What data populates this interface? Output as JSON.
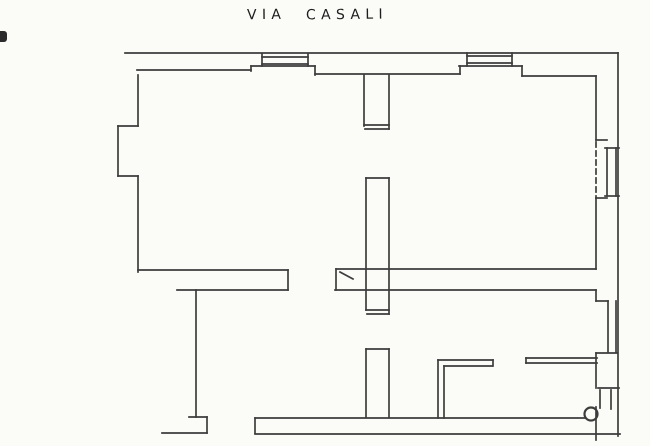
{
  "page": {
    "background_color": "#fbfbf8",
    "ink_color": "#3d3d3d",
    "title": {
      "street_word_1": "VIA",
      "street_word_2": "CASALI"
    }
  },
  "plan": {
    "canvas": {
      "width": 650,
      "height": 446
    },
    "stroke_color": "#3d3d3d",
    "stroke_width": 1.7,
    "wall_groups": [
      {
        "name": "outer-walls",
        "segments": [
          [
            125,
            53,
            618,
            53
          ],
          [
            618,
            53,
            618,
            436
          ],
          [
            255,
            434,
            620,
            434
          ],
          [
            162,
            433,
            207,
            433
          ]
        ]
      },
      {
        "name": "left-wall-with-bay",
        "segments": [
          [
            138,
            75,
            138,
            126
          ],
          [
            138,
            126,
            118,
            126
          ],
          [
            118,
            126,
            118,
            176
          ],
          [
            118,
            176,
            138,
            176
          ],
          [
            138,
            176,
            138,
            272
          ]
        ]
      },
      {
        "name": "top-wall-inner-face",
        "segments": [
          [
            137,
            70,
            251,
            70
          ],
          [
            251,
            66,
            251,
            71
          ],
          [
            251,
            66,
            315,
            66
          ],
          [
            315,
            66,
            315,
            75
          ],
          [
            315,
            74,
            460,
            74
          ],
          [
            460,
            66,
            460,
            74
          ],
          [
            459,
            66,
            522,
            66
          ],
          [
            522,
            66,
            522,
            76
          ],
          [
            522,
            76,
            596,
            76
          ]
        ]
      },
      {
        "name": "top-window-left",
        "segments": [
          [
            262,
            57,
            308,
            57
          ],
          [
            262,
            64,
            308,
            64
          ],
          [
            262,
            54,
            262,
            66
          ],
          [
            308,
            54,
            308,
            66
          ]
        ]
      },
      {
        "name": "top-window-right",
        "segments": [
          [
            467,
            56,
            512,
            56
          ],
          [
            467,
            63,
            512,
            63
          ],
          [
            467,
            53,
            467,
            66
          ],
          [
            512,
            53,
            512,
            66
          ]
        ]
      },
      {
        "name": "partition-upper",
        "segments": [
          [
            364,
            75,
            364,
            126
          ],
          [
            389,
            75,
            389,
            129
          ],
          [
            364,
            125,
            389,
            125
          ],
          [
            365,
            129,
            389,
            129
          ]
        ]
      },
      {
        "name": "partition-middle",
        "segments": [
          [
            366,
            178,
            366,
            310
          ],
          [
            389,
            178,
            389,
            314
          ],
          [
            366,
            178,
            389,
            178
          ],
          [
            366,
            310,
            389,
            310
          ],
          [
            367,
            314,
            389,
            314
          ]
        ]
      },
      {
        "name": "partition-lower",
        "segments": [
          [
            366,
            349,
            366,
            417
          ],
          [
            389,
            349,
            389,
            417
          ],
          [
            366,
            349,
            389,
            349
          ]
        ]
      },
      {
        "name": "cross-wall-left",
        "segments": [
          [
            138,
            270,
            288,
            270
          ],
          [
            177,
            290,
            288,
            290
          ],
          [
            288,
            270,
            288,
            290
          ]
        ]
      },
      {
        "name": "cross-wall-right",
        "segments": [
          [
            336,
            269,
            596,
            269
          ],
          [
            335,
            290,
            596,
            290
          ],
          [
            336,
            269,
            336,
            290
          ]
        ]
      },
      {
        "name": "lower-left-boundary",
        "segments": [
          [
            196,
            290,
            196,
            417
          ],
          [
            189,
            417,
            207,
            417
          ],
          [
            207,
            417,
            207,
            433
          ]
        ]
      },
      {
        "name": "l-shaped-wall",
        "segments": [
          [
            438,
            360,
            493,
            360
          ],
          [
            444,
            366,
            492,
            366
          ],
          [
            493,
            360,
            493,
            366
          ],
          [
            438,
            360,
            438,
            418
          ],
          [
            444,
            366,
            444,
            418
          ]
        ]
      },
      {
        "name": "lower-right-wall",
        "segments": [
          [
            526,
            358,
            597,
            358
          ],
          [
            526,
            363,
            597,
            363
          ],
          [
            526,
            358,
            526,
            363
          ]
        ]
      },
      {
        "name": "right-wall-with-windows",
        "segments": [
          [
            596,
            76,
            596,
            140
          ],
          [
            596,
            140,
            607,
            140
          ],
          [
            607,
            148,
            607,
            196
          ],
          [
            616,
            148,
            616,
            196
          ],
          [
            605,
            148,
            619,
            148
          ],
          [
            605,
            196,
            619,
            196
          ],
          [
            596,
            198,
            607,
            198
          ],
          [
            596,
            198,
            596,
            269
          ],
          [
            596,
            290,
            596,
            301
          ],
          [
            596,
            301,
            608,
            301
          ],
          [
            608,
            301,
            608,
            352
          ],
          [
            616,
            301,
            616,
            352
          ],
          [
            596,
            353,
            617,
            353
          ],
          [
            596,
            353,
            596,
            388
          ],
          [
            598,
            388,
            619,
            388
          ],
          [
            600,
            390,
            600,
            408
          ],
          [
            611,
            390,
            611,
            409
          ],
          [
            596,
            407,
            596,
            440
          ]
        ]
      },
      {
        "name": "bottom-wall-inner-face",
        "segments": [
          [
            255,
            418,
            585,
            418
          ],
          [
            255,
            418,
            255,
            433
          ]
        ]
      }
    ],
    "dashed_walls": [
      [
        596,
        142,
        596,
        198
      ]
    ],
    "door_swing_marks": [
      [
        340,
        272,
        353,
        279
      ]
    ],
    "circles": [
      {
        "cx": 591,
        "cy": 414,
        "r": 6.5
      }
    ]
  }
}
